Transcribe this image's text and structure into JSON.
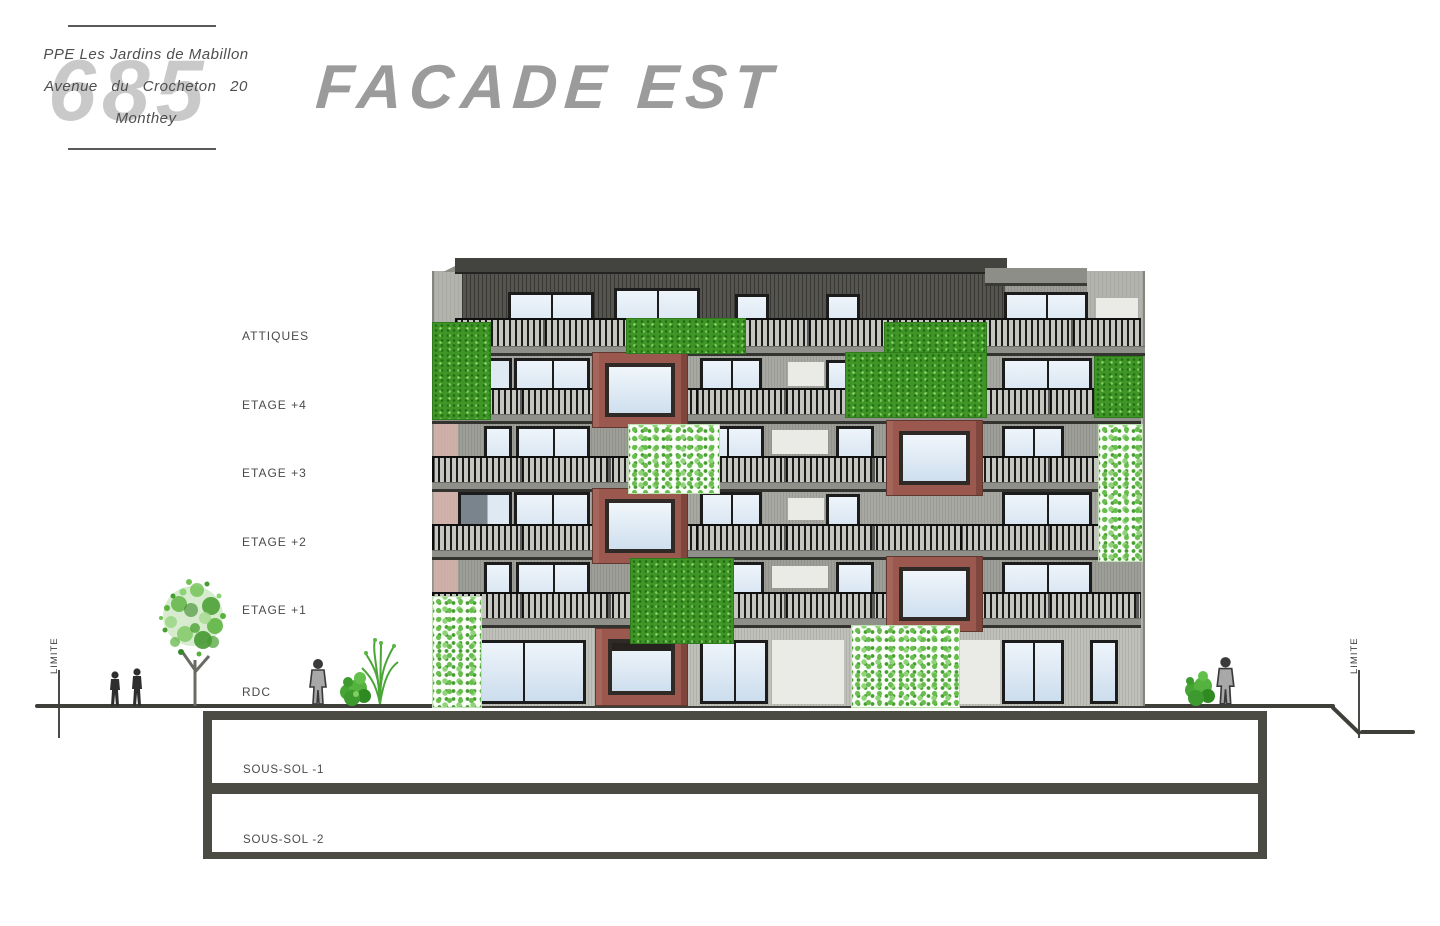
{
  "title": "FACADE EST",
  "title_block": {
    "sheet_number": "685",
    "project": "PPE Les Jardins de Mabillon",
    "address": "Avenue du Crocheton 20",
    "city": "Monthey"
  },
  "floor_labels": [
    {
      "label": "ATTIQUES"
    },
    {
      "label": "ETAGE +4"
    },
    {
      "label": "ETAGE +3"
    },
    {
      "label": "ETAGE +2"
    },
    {
      "label": "ETAGE +1"
    },
    {
      "label": "RDC"
    }
  ],
  "basement": {
    "level1": "SOUS-SOL -1",
    "level2": "SOUS-SOL -2"
  },
  "boundary": {
    "left": "LIMITE",
    "right": "LIMITE"
  },
  "colors": {
    "drawing_title": "#9b9b9b",
    "label_text": "#4a4a4a",
    "roof": "#434340",
    "attic_wall": "#55544f",
    "facade_wall": "#b3b3ae",
    "window_frame": "#1c1c1c",
    "glass": "#dce9f4",
    "red_frame": "#9a584e",
    "green_dense": "#3f9627",
    "green_leafy": "#7cc768",
    "salmon_wall": "#d9b4ab",
    "ground": "#3f3f3a",
    "basement_outline": "#4b4b43"
  }
}
